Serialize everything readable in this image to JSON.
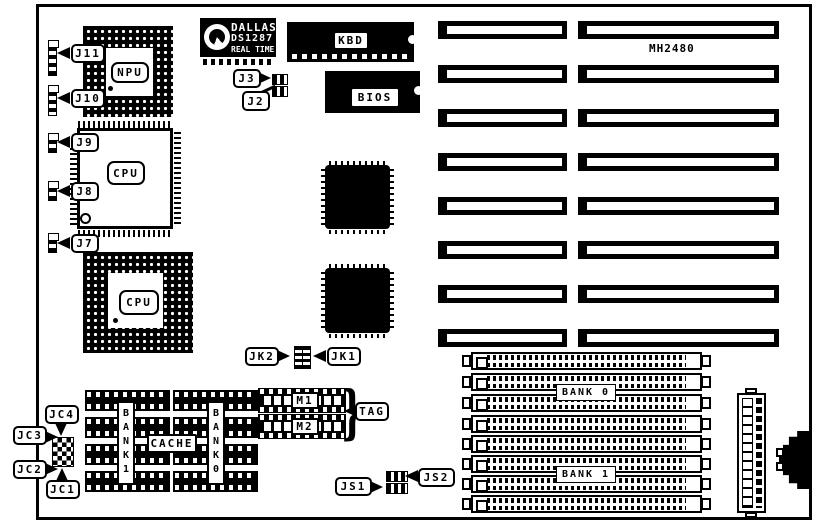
{
  "board": {
    "model_label": "MH2480"
  },
  "dallas_rtc": {
    "line1": "DALLAS",
    "line2": "DS1287",
    "line3": "REAL TIME"
  },
  "chips": {
    "npu": "NPU",
    "cpu_qfp": "CPU",
    "cpu_pga": "CPU",
    "kbd": "KBD",
    "bios": "BIOS",
    "m1": "M1",
    "m2": "M2",
    "tag": "TAG",
    "cache": "CACHE",
    "bank1_column": "BANK1",
    "bank0_column": "BANK0"
  },
  "memory_banks": {
    "bank0": "BANK 0",
    "bank1": "BANK 1"
  },
  "jumpers": {
    "j11": "J11",
    "j10": "J10",
    "j9": "J9",
    "j8": "J8",
    "j7": "J7",
    "j3": "J3",
    "j2": "J2",
    "jk1": "JK1",
    "jk2": "JK2",
    "jc1": "JC1",
    "jc2": "JC2",
    "jc3": "JC3",
    "jc4": "JC4",
    "js1": "JS1",
    "js2": "JS2"
  }
}
